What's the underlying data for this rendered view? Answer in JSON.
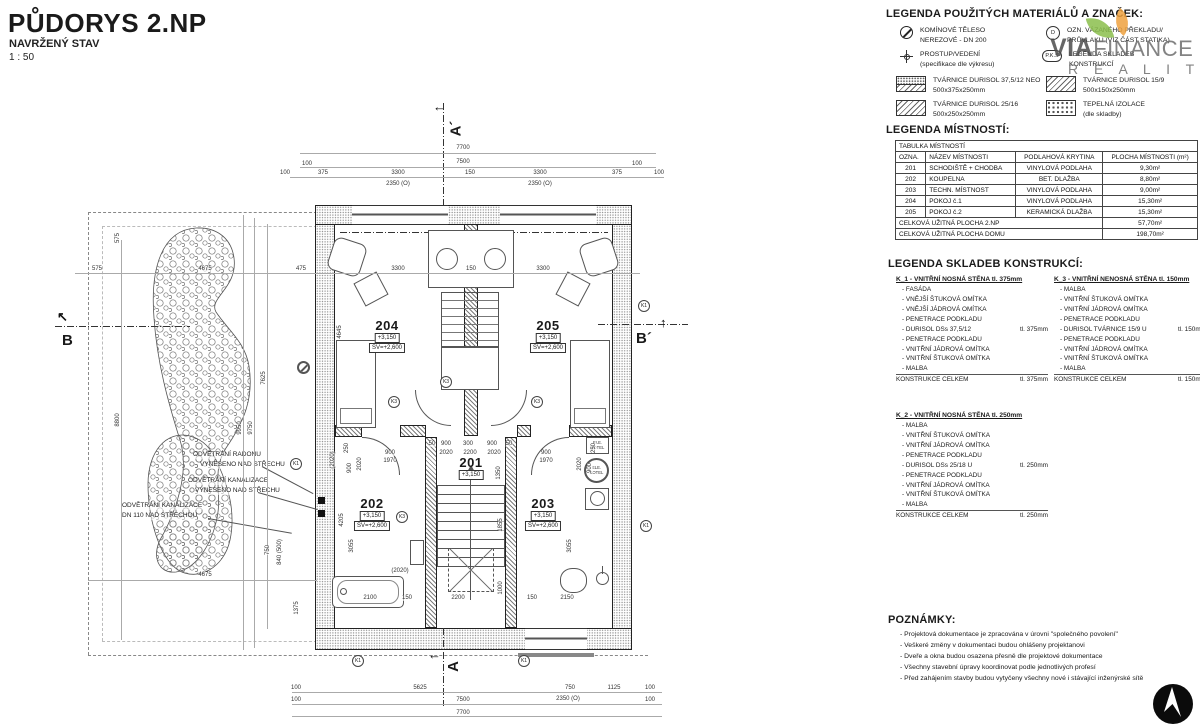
{
  "title": {
    "main": "PŮDORYS 2.NP",
    "sub": "NAVRŽENÝ STAV",
    "scale": "1 : 50"
  },
  "watermark": {
    "via": "VIA",
    "finance": "FINANCE",
    "reality": "R E A L I T Y",
    "green": "#8bbf4d",
    "orange": "#efa23f"
  },
  "legend_materials": {
    "heading": "LEGENDA POUŽITÝCH MATERIÁLŮ A ZNAČEK:",
    "symbols": [
      {
        "l1": "KOMÍNOVÉ TĚLESO",
        "l2": "NEREZOVÉ - DN 200"
      },
      {
        "l1": "PROSTUP/VEDENÍ",
        "l2": "(specifikace dle výkresu)"
      },
      {
        "badge": "D",
        "l1": "OZN. VÁZANÉHO PŘEKLADU/",
        "l2": "PRŮVLAKU (VIZ ČÁST STATIKA)"
      },
      {
        "badge": "P.K.S",
        "l1": "LEGENDA SKLADEB",
        "l2": "KONSTRUKCÍ"
      }
    ],
    "hatches": [
      {
        "l1": "TVÁRNICE DURISOL 37,5/12 NEO",
        "l2": "500x375x250mm"
      },
      {
        "l1": "TVÁRNICE DURISOL 25/16",
        "l2": "500x250x250mm"
      },
      {
        "l1": "TVÁRNICE DURISOL 15/9",
        "l2": "500x150x250mm"
      },
      {
        "l1": "TEPELNÁ IZOLACE",
        "l2": "(dle skladby)"
      }
    ]
  },
  "legend_rooms": {
    "heading": "LEGENDA MÍSTNOSTÍ:",
    "table_title": "TABULKA MÍSTNOSTÍ",
    "columns": [
      "OZNA.",
      "NÁZEV MÍSTNOSTI",
      "PODLAHOVÁ KRYTINA",
      "PLOCHA MÍSTNOSTI (m²)"
    ],
    "rows": [
      [
        "201",
        "SCHODIŠTĚ + CHODBA",
        "VINYLOVÁ PODLAHA",
        "9,30m²"
      ],
      [
        "202",
        "KOUPELNA",
        "BET. DLAŽBA",
        "8,80m²"
      ],
      [
        "203",
        "TECHN. MÍSTNOST",
        "VINYLOVÁ PODLAHA",
        "9,00m²"
      ],
      [
        "204",
        "POKOJ č.1",
        "VINYLOVÁ PODLAHA",
        "15,30m²"
      ],
      [
        "205",
        "POKOJ č.2",
        "KERAMICKÁ DLAŽBA",
        "15,30m²"
      ]
    ],
    "totals": [
      {
        "label": "CELKOVÁ UŽITNÁ PLOCHA 2.NP",
        "value": "57,70m²"
      },
      {
        "label": "CELKOVÁ UŽITNÁ PLOCHA DOMU",
        "value": "198,70m²"
      }
    ]
  },
  "legend_constructions": {
    "heading": "LEGENDA SKLADEB KONSTRUKCÍ:",
    "k1": {
      "title": "K_1 - VNITŘNÍ NOSNÁ STĚNA tl. 375mm",
      "layers": [
        {
          "t": "- FASÁDA",
          "r": ""
        },
        {
          "t": "- VNĚJŠÍ ŠTUKOVÁ OMÍTKA",
          "r": ""
        },
        {
          "t": "- VNĚJŠÍ JÁDROVÁ OMÍTKA",
          "r": ""
        },
        {
          "t": "- PENETRACE PODKLADU",
          "r": ""
        },
        {
          "t": "- DURISOL DSs 37,5/12",
          "r": "tl. 375mm"
        },
        {
          "t": "- PENETRACE PODKLADU",
          "r": ""
        },
        {
          "t": "- VNITŘNÍ JÁDROVÁ OMÍTKA",
          "r": ""
        },
        {
          "t": "- VNITŘNÍ ŠTUKOVÁ OMÍTKA",
          "r": ""
        },
        {
          "t": "- MALBA",
          "r": ""
        }
      ],
      "total_label": "KONSTRUKCE CELKEM",
      "total_value": "tl. 375mm"
    },
    "k2": {
      "title": "K_2 - VNITŘNÍ NOSNÁ STĚNA tl. 250mm",
      "layers": [
        {
          "t": "- MALBA",
          "r": ""
        },
        {
          "t": "- VNITŘNÍ ŠTUKOVÁ OMÍTKA",
          "r": ""
        },
        {
          "t": "- VNITŘNÍ JÁDROVÁ OMÍTKA",
          "r": ""
        },
        {
          "t": "- PENETRACE PODKLADU",
          "r": ""
        },
        {
          "t": "- DURISOL DSs 25/18 U",
          "r": "tl. 250mm"
        },
        {
          "t": "- PENETRACE PODKLADU",
          "r": ""
        },
        {
          "t": "- VNITŘNÍ JÁDROVÁ OMÍTKA",
          "r": ""
        },
        {
          "t": "- VNITŘNÍ ŠTUKOVÁ OMÍTKA",
          "r": ""
        },
        {
          "t": "- MALBA",
          "r": ""
        }
      ],
      "total_label": "KONSTRUKCE CELKEM",
      "total_value": "tl. 250mm"
    },
    "k3": {
      "title": "K_3 - VNITŘNÍ NENOSNÁ STĚNA tl. 150mm",
      "layers": [
        {
          "t": "- MALBA",
          "r": ""
        },
        {
          "t": "- VNITŘNÍ ŠTUKOVÁ OMÍTKA",
          "r": ""
        },
        {
          "t": "- VNITŘNÍ JÁDROVÁ OMÍTKA",
          "r": ""
        },
        {
          "t": "- PENETRACE PODKLADU",
          "r": ""
        },
        {
          "t": "- DURISOL TVÁRNICE 15/9 U",
          "r": "tl. 150mm"
        },
        {
          "t": "- PENETRACE PODKLADU",
          "r": ""
        },
        {
          "t": "- VNITŘNÍ JÁDROVÁ OMÍTKA",
          "r": ""
        },
        {
          "t": "- VNITŘNÍ ŠTUKOVÁ OMÍTKA",
          "r": ""
        },
        {
          "t": "- MALBA",
          "r": ""
        }
      ],
      "total_label": "KONSTRUKCE CELKEM",
      "total_value": "tl. 150mm"
    }
  },
  "notes": {
    "heading": "POZNÁMKY:",
    "items": [
      "- Projektová dokumentace je zpracována v úrovni \"společného povolení\"",
      "- Veškeré změny v dokumentaci budou ohlášeny projektanovi",
      "- Dveře a okna budou osazena přesně dle projektové dokumentace",
      "- Všechny stavební úpravy koordinovat podle jednotlivých profesí",
      "- Před zahájením stavby budou vytyčeny všechny nové i stávající inženýrské sítě"
    ]
  },
  "plan": {
    "rooms": [
      {
        "num": "204",
        "elev": "+3,150",
        "sv": "SV=+2,600"
      },
      {
        "num": "205",
        "elev": "+3,150",
        "sv": "SV=+2,600"
      },
      {
        "num": "201",
        "elev": "+3,150"
      },
      {
        "num": "202",
        "elev": "+3,150",
        "sv": "SV=+2,600"
      },
      {
        "num": "203",
        "elev": "+3,150",
        "sv": "SV=+2,600"
      }
    ],
    "markers": {
      "a": "A",
      "a_prime": "A´",
      "b": "B",
      "b_prime": "B´",
      "k1": "K1",
      "k3": "K3"
    },
    "ele_kotel": "ELE. KOTEL",
    "annotations": {
      "ann1a": "ODVĚTRÁNÍ RADONU",
      "ann1b": "VYNESENO NAD STŘECHU",
      "ann2a": "ODVĚTRÁNÍ KANALIZACE",
      "ann2b": "VYNESENO NAD STŘECHU",
      "ann3a": "ODVĚTRÁNÍ KANALIZACE",
      "ann3b": "DN 110 NAD STŘECHOU"
    },
    "dims": {
      "top1": "7700",
      "top2": "7500",
      "t100L": "100",
      "t100a": "100",
      "t375a": "375",
      "t3300a": "3300",
      "t150": "150",
      "t3300b": "3300",
      "t375b": "375",
      "t100b": "100",
      "t100R": "100",
      "twin1": "2350 (O)",
      "twin2": "2350 (O)",
      "b100L": "100",
      "b5625": "5625",
      "b750": "750",
      "b1125": "1125",
      "b100R": "100",
      "b100L2": "100",
      "b7500": "7500",
      "bwin": "2350 (O)",
      "b100R2": "100",
      "b7700": "7700",
      "l575v": "575",
      "l575h": "575",
      "l4675": "4675",
      "l475": "475",
      "l4675b": "4675",
      "l8800": "8800",
      "l9950": "9950",
      "l9750": "9750",
      "l7625": "7625",
      "l1375": "1375",
      "l750": "750",
      "l840": "840 (500)",
      "r3300a": "3300",
      "r150": "150",
      "r3300b": "3300",
      "v4645": "4645",
      "s50a": "50",
      "s900a": "900",
      "s300": "300",
      "s900b": "900",
      "s50b": "50",
      "s2020a": "2020",
      "s2200": "2200",
      "s2020b": "2020",
      "d900a": "900",
      "d1970a": "1970",
      "d900b": "900",
      "d1970b": "1970",
      "v1350": "1350",
      "v1855": "1855",
      "v1000": "1000",
      "v3055a": "3055",
      "v3055b": "3055",
      "v4205": "4205",
      "p2020a": "(2020)",
      "p2020b": "(2020)",
      "w2100": "2100",
      "w150a": "150",
      "w2200": "2200",
      "w150b": "150",
      "w2150": "2150",
      "e250a": "250",
      "e900a": "900",
      "e2020a": "2020",
      "e250b": "250",
      "e900b": "900",
      "e2020b": "2020"
    }
  }
}
